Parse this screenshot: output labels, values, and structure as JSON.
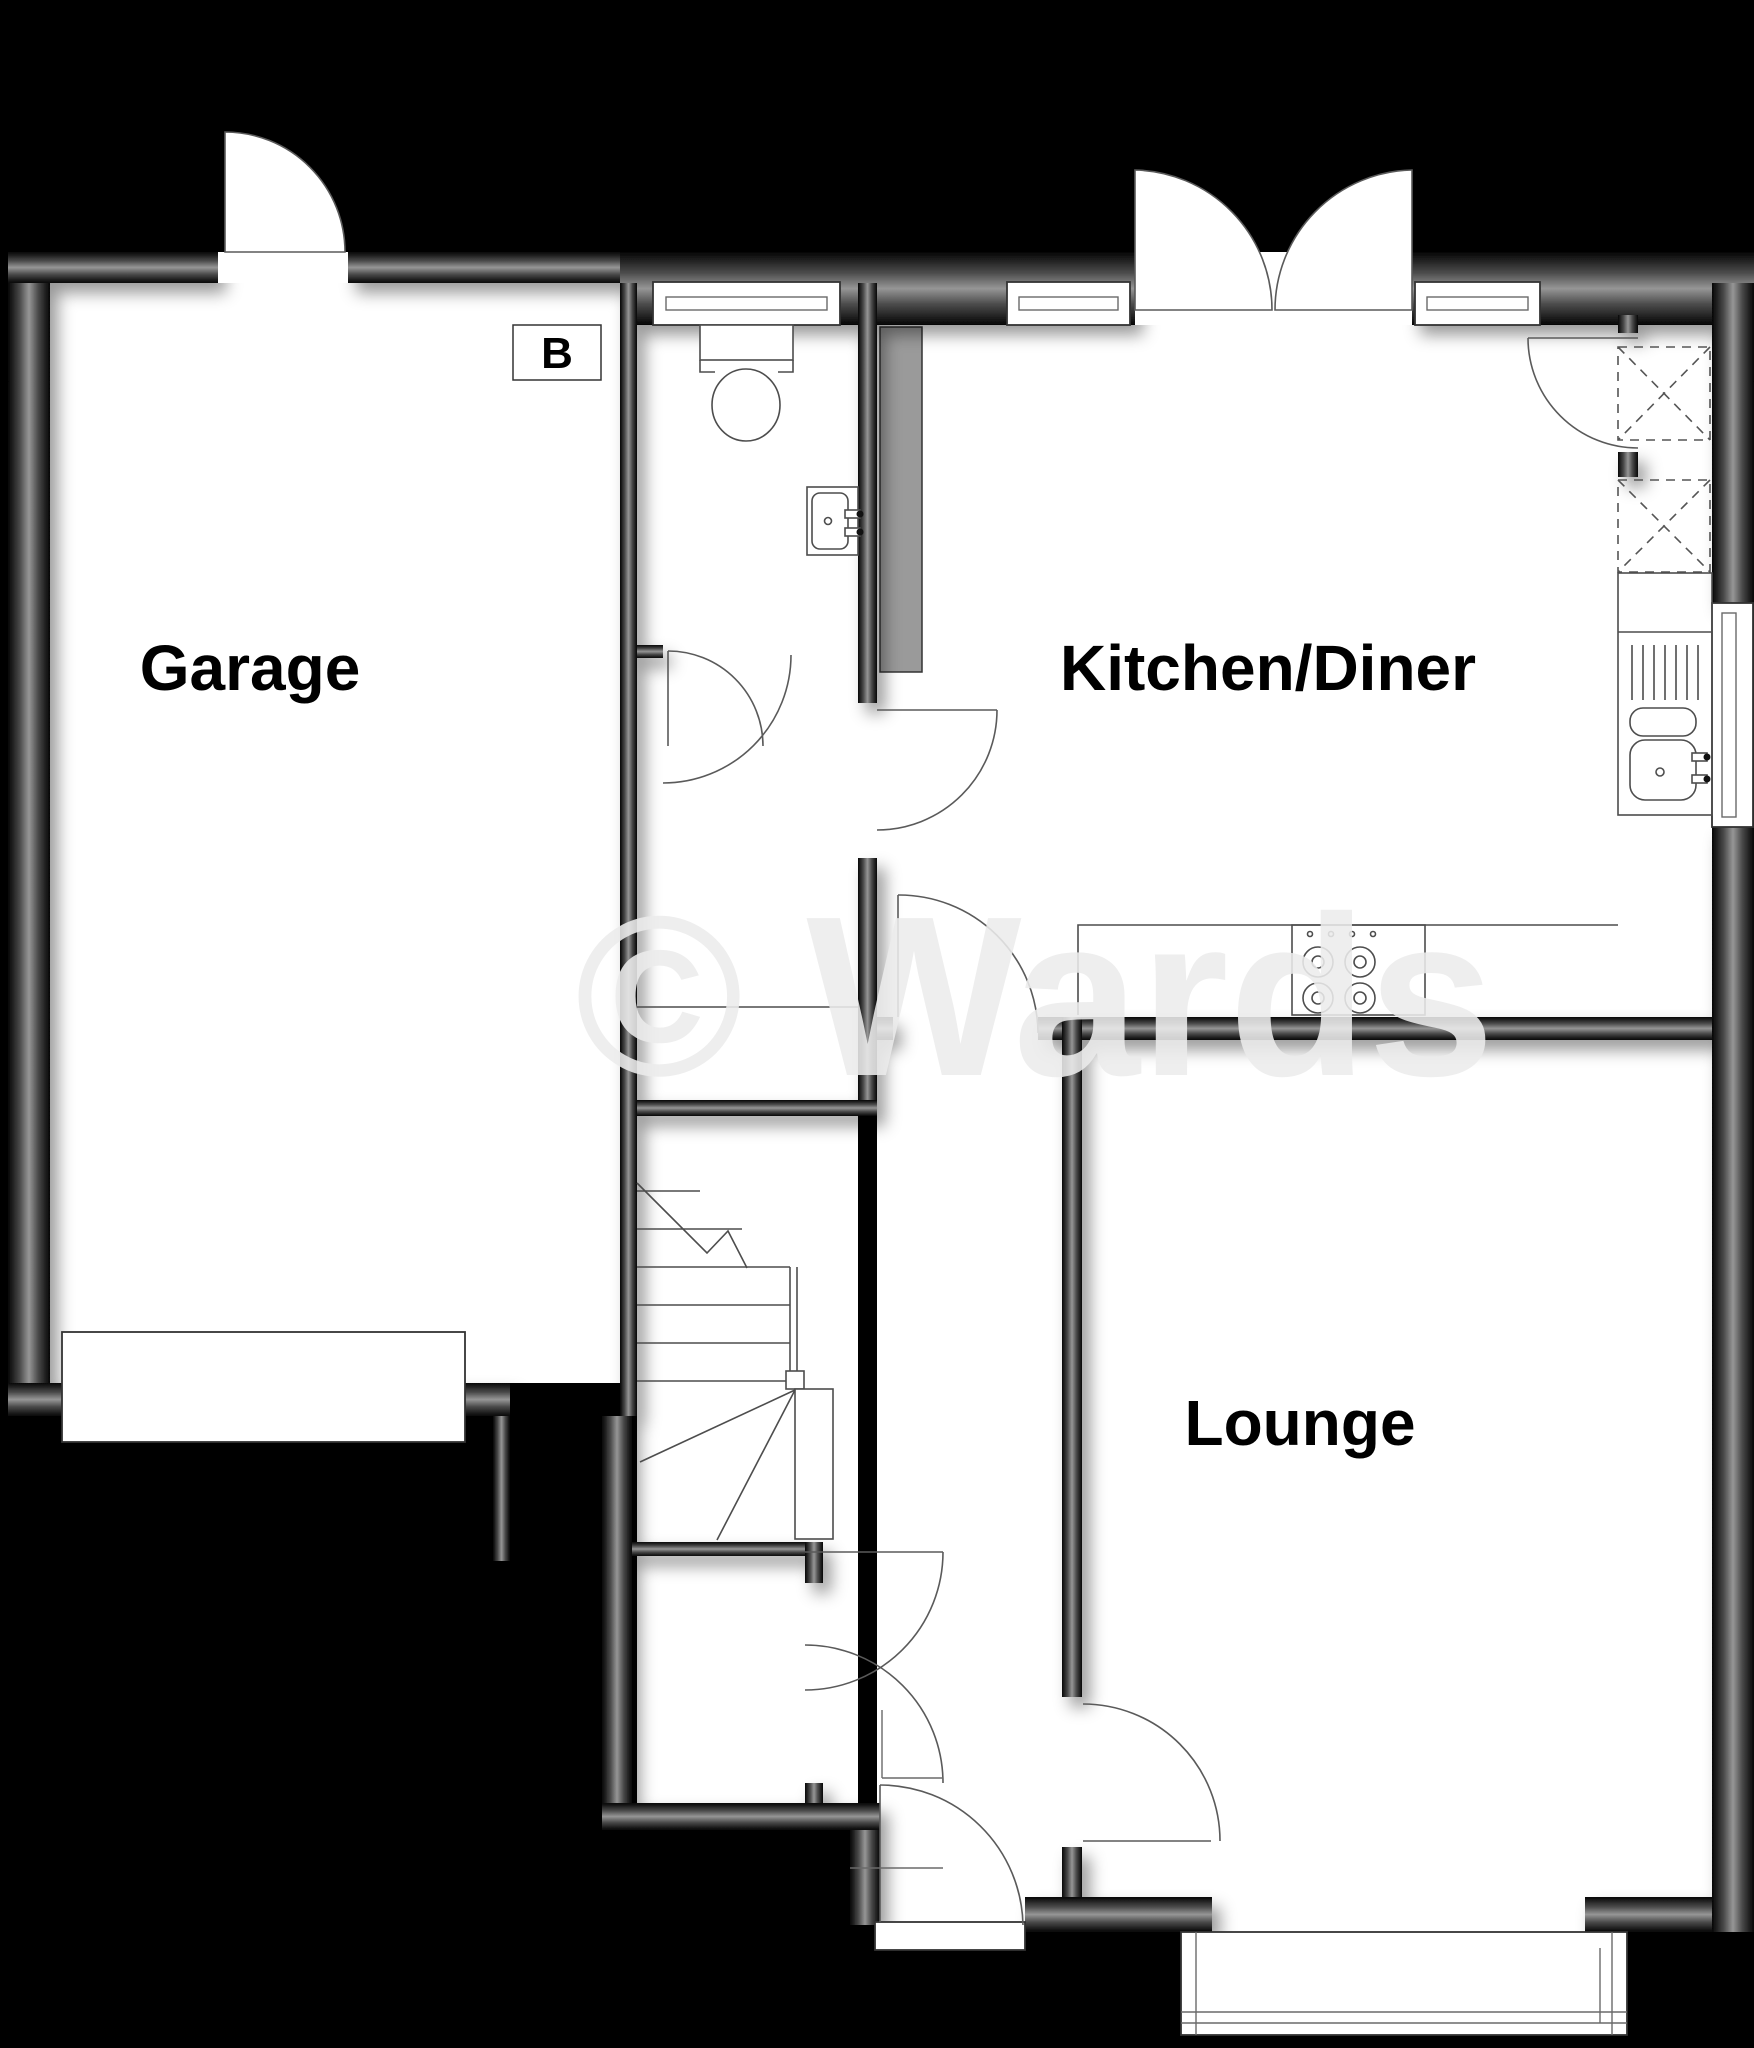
{
  "plan": {
    "type": "floor-plan",
    "watermark": "© Wards",
    "rooms": {
      "garage": {
        "label": "Garage"
      },
      "kitchen": {
        "label": "Kitchen/Diner"
      },
      "lounge": {
        "label": "Lounge"
      }
    },
    "markers": {
      "boiler": "B"
    },
    "colors": {
      "background": "#000000",
      "floor": "#ffffff",
      "wall_mid": "#969696",
      "wall_edge": "#050505",
      "fixture_line": "#4d4d4d",
      "duct_fill": "#9a9a9a",
      "watermark": "#ececec"
    }
  }
}
